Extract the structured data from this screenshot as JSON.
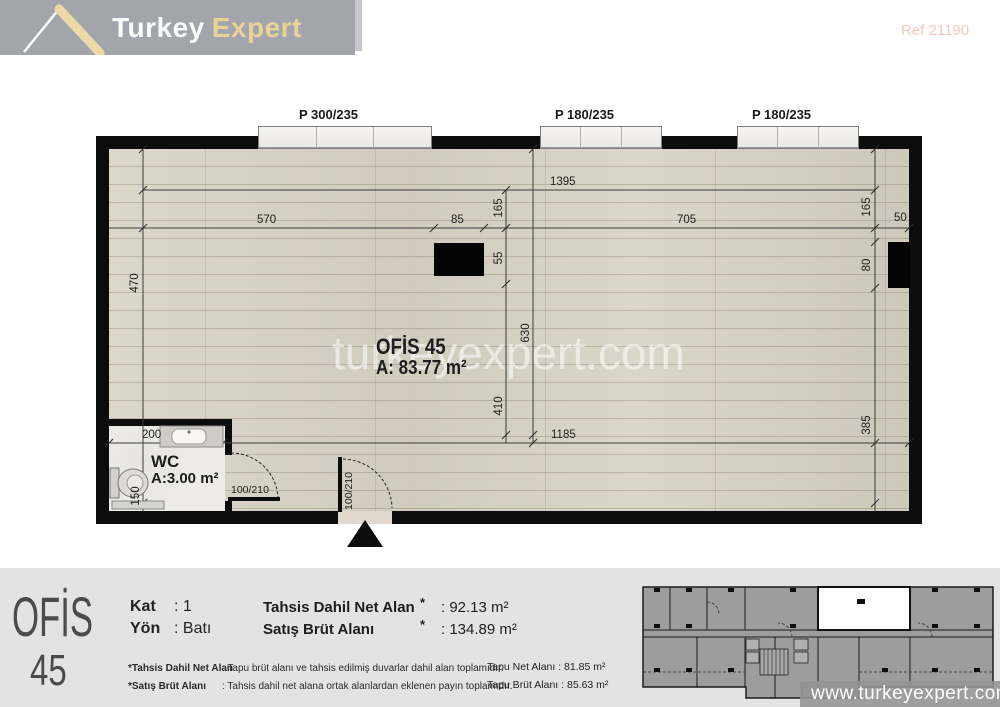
{
  "header": {
    "brand_first": "Turkey",
    "brand_second": "Expert",
    "ref": "Ref 21190"
  },
  "watermark": "turkeyexpert.com",
  "plan": {
    "windows": [
      {
        "label": "P 300/235"
      },
      {
        "label": "P 180/235"
      },
      {
        "label": "P 180/235"
      }
    ],
    "room_name": "OFİS 45",
    "room_area": "A: 83.77 m²",
    "wc_name": "WC",
    "wc_area": "A:3.00 m²",
    "door_wc": "100/210",
    "door_entry": "100/210",
    "dims": {
      "left_height": "470",
      "top_width": "1395",
      "seg_a": "570",
      "seg_b": "85",
      "seg_c": "705",
      "seg_d": "50",
      "mid_top": "165",
      "mid_col": "55",
      "mid_low": "410",
      "partition": "630",
      "right_top": "165",
      "right_col": "80",
      "right_low": "385",
      "wc_width": "200",
      "bottom_width": "1185",
      "wc_height": "150"
    }
  },
  "footer": {
    "unit_line1": "OFİS",
    "unit_line2": "45",
    "rows": [
      {
        "label": "Kat",
        "value": ": 1"
      },
      {
        "label": "Yön",
        "value": ": Batı"
      }
    ],
    "areas": [
      {
        "label": "Tahsis Dahil Net Alan",
        "star": "*",
        "value": ":  92.13 m²"
      },
      {
        "label": "Satış Brüt Alanı",
        "star": "*",
        "value": ": 134.89 m²"
      }
    ],
    "notes": [
      {
        "label": "*Tahsis Dahil Net Alan",
        "text": ":  Tapu brüt alanı ve tahsis edilmiş duvarlar dahil alan toplamıdır."
      },
      {
        "label": "*Satış Brüt Alanı",
        "text": ":  Tahsis dahil net alana ortak alanlardan eklenen payın toplamıdır."
      }
    ],
    "tapu": [
      {
        "label": "Tapu Net Alanı",
        "value": ":  81.85 m²"
      },
      {
        "label": "Tapu Brüt Alanı",
        "value": ":  85.63 m²"
      }
    ],
    "website": "www.turkeyexpert.com"
  }
}
